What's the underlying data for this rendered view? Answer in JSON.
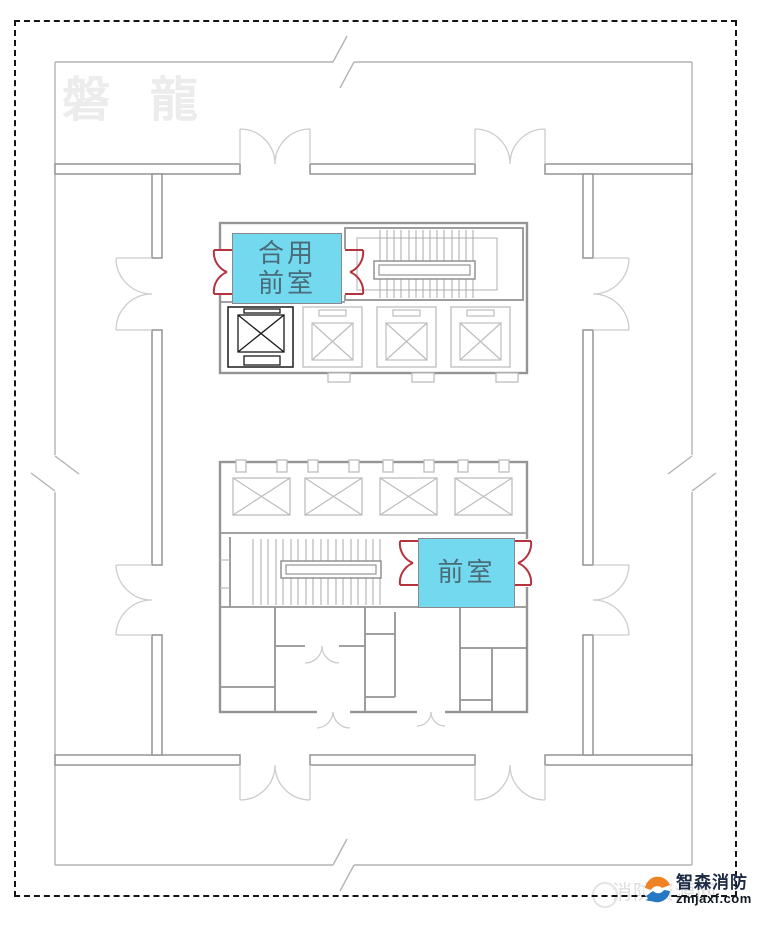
{
  "watermarks": {
    "top_left": "磐 龍",
    "bottom_right_text": "消防资源网"
  },
  "rooms": {
    "shared_front_room": {
      "line1": "合用",
      "line2": "前室"
    },
    "front_room": {
      "label": "前室"
    }
  },
  "logo": {
    "brand": "智森消防",
    "website": "zmjaxf.com"
  },
  "colors": {
    "room_highlight": "#72D9EF",
    "room_label": "#4A6B78",
    "fire_door": "#B5333D",
    "wall_main": "#949494",
    "wall_outer": "#B3B3B3",
    "wall_soft": "#BDBDBD",
    "stair_line": "#A8A8A8",
    "door_arc": "#CCCCCC",
    "elevator_dark": "#1A1A1A",
    "border_dash": "#151515",
    "watermark_gray": "#ECECEC",
    "logo_orange": "#F08223",
    "logo_blue": "#2778C4"
  }
}
